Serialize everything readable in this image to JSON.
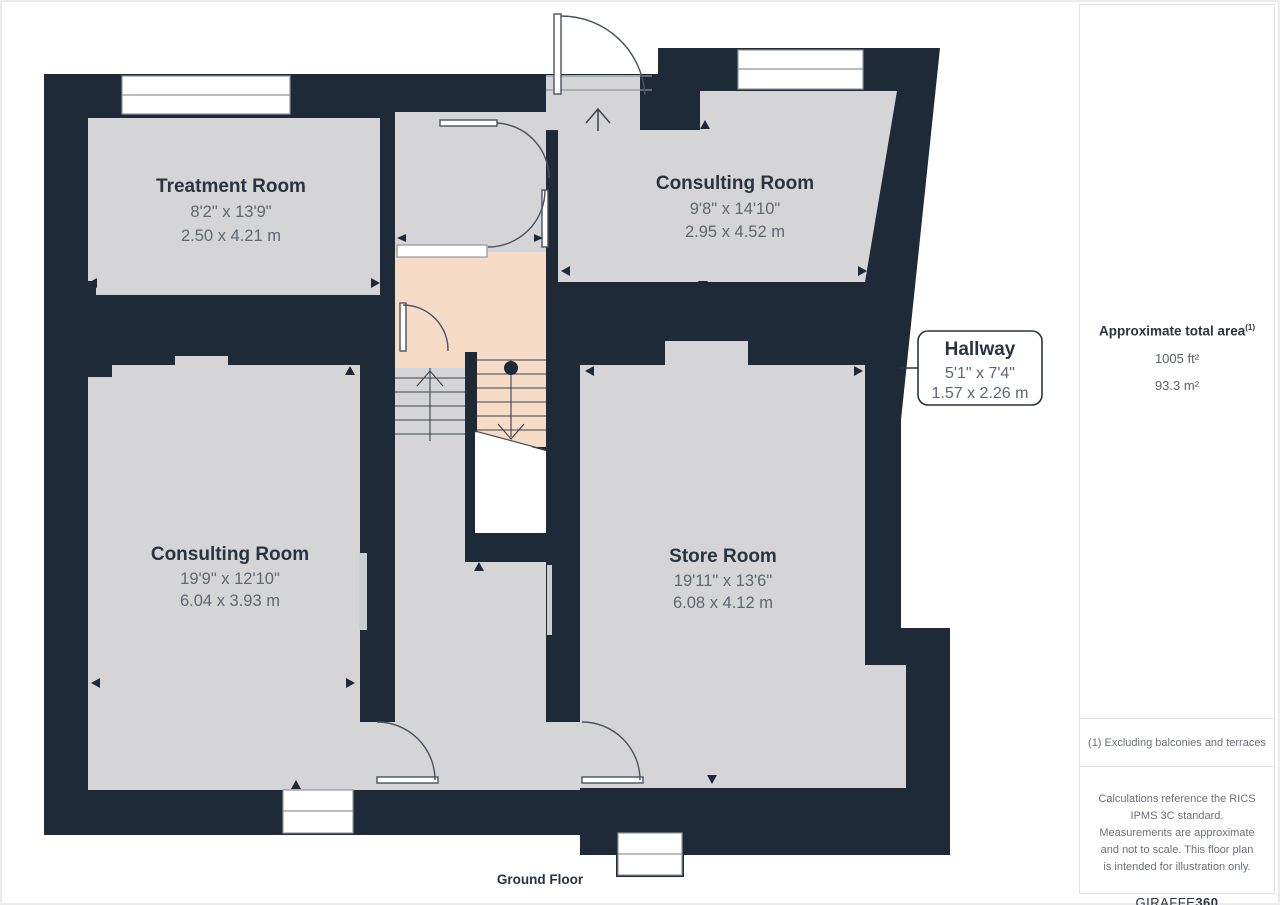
{
  "floor_label": "Ground Floor",
  "colors": {
    "wall": "#1F2A38",
    "room_fill": "#D5D5D7",
    "hallway_fill": "#F6DBC7",
    "text_primary": "#2A3342",
    "text_secondary": "#5F6670",
    "page_border": "#ECECEC"
  },
  "rooms": [
    {
      "name": "Treatment Room",
      "imperial": "8'2\" x 13'9\"",
      "metric": "2.50 x 4.21 m"
    },
    {
      "name": "Consulting Room",
      "imperial": "9'8\" x 14'10\"",
      "metric": "2.95 x 4.52 m"
    },
    {
      "name": "Consulting Room",
      "imperial": "19'9\" x 12'10\"",
      "metric": "6.04 x 3.93 m"
    },
    {
      "name": "Store Room",
      "imperial": "19'11\" x 13'6\"",
      "metric": "6.08 x 4.12 m"
    }
  ],
  "callout": {
    "name": "Hallway",
    "imperial": "5'1\" x 7'4\"",
    "metric": "1.57 x 2.26 m"
  },
  "sidebar": {
    "total_area_label": "Approximate total area",
    "total_area_sup": "(1)",
    "area_ft": "1005 ft²",
    "area_m": "93.3 m²",
    "footnote": "(1) Excluding balconies and terraces",
    "disclaimer": "Calculations reference the RICS IPMS 3C standard. Measurements are approximate and not to scale. This floor plan is intended for illustration only.",
    "brand": "GIRAFFE",
    "brand_bold": "360"
  }
}
